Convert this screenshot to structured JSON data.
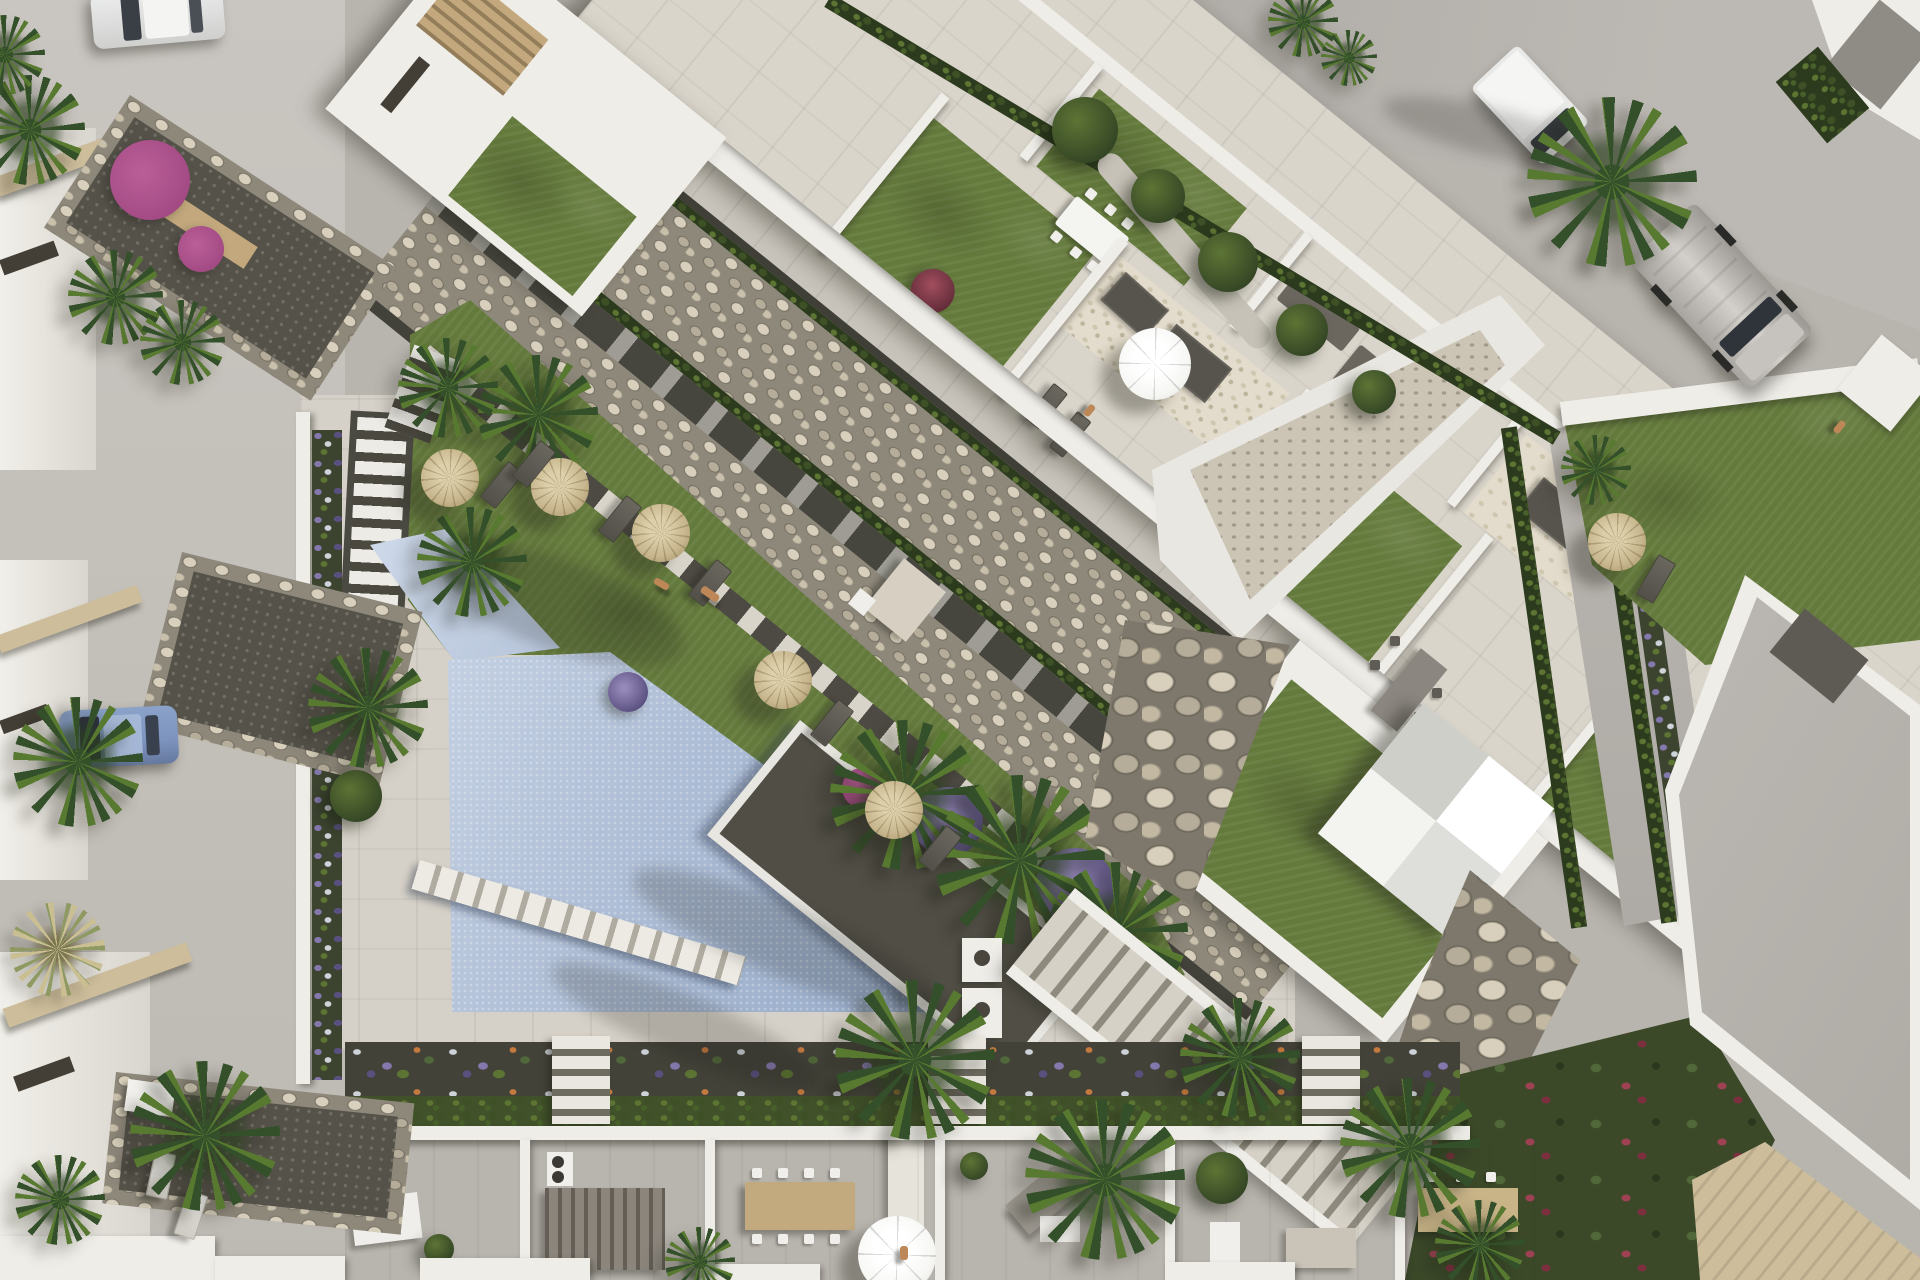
{
  "scene": {
    "kind": "aerial-architectural-render",
    "subject": "Top-down 3D visualization of a new-build residential complex with communal pool, lawns, straw parasols, roof terraces, streets and parked vehicles",
    "time_of_day": "late afternoon with long shadows toward lower-left",
    "no_visible_text": true
  },
  "palette": {
    "base": "#b8b4ae",
    "street": "#c4c0ba",
    "road": "#a8a49f",
    "roadLight": "#bcb8b3",
    "deck": "#d6d1c8",
    "pavement": "#dad5cb",
    "wall": "#efede8",
    "wallShade": "#b9b5ae",
    "pool": "#b2c1d8",
    "poolLight": "#cfdaea",
    "poolDeep": "#93a8c7",
    "grass": "#647a3c",
    "grassLight": "#7e9350",
    "grassDark": "#46572b",
    "stoneBed": "#8e887b",
    "stoneLight": "#d8d0bc",
    "stoneMid": "#b5ad99",
    "stoneEdge": "#676257",
    "soil": "#504e45",
    "gravelDark": "#434239",
    "hedge": "#3e5026",
    "hedgeLight": "#5d7533",
    "forest": "#3b4929",
    "palm": "#587a30",
    "palmDark": "#34502a",
    "straw": "#c7b68e",
    "strawDark": "#9f8d60",
    "canvasWhite": "#f6f6f3",
    "purple": "#8478ad",
    "purpleDeep": "#5a5080",
    "magenta": "#a34a84",
    "sand": "#cdbd9b",
    "wood": "#c2a87c",
    "mat": "#57544d",
    "carBlue": "#7c93be",
    "metal": "#bab7b2",
    "skin": "#bd8757",
    "redPlant": "#9c4252"
  },
  "objects": {
    "vehicles": [
      {
        "name": "white-car",
        "location": "top-left street"
      },
      {
        "name": "blue-car",
        "location": "left street, parked by facade"
      },
      {
        "name": "white-box-van",
        "location": "top-right road"
      },
      {
        "name": "silver-van",
        "location": "top-right driveway"
      }
    ],
    "amenities": [
      {
        "name": "swimming-pool",
        "color_key": "pool"
      },
      {
        "name": "pool-step-bridge"
      },
      {
        "name": "straw-parasols",
        "count": 6
      },
      {
        "name": "white-terrace-parasol",
        "count": 1
      },
      {
        "name": "white-pyramid-tent",
        "count": 1
      },
      {
        "name": "sun-loungers",
        "count": 9
      },
      {
        "name": "outdoor-dining-sets",
        "count": 5
      },
      {
        "name": "outdoor-shower"
      },
      {
        "name": "garden-stairs",
        "count": 3
      },
      {
        "name": "white-railed-ramp"
      }
    ],
    "landscape": [
      {
        "name": "diagonal-pebble-dry-riverbed"
      },
      {
        "name": "boulder-retaining-walls"
      },
      {
        "name": "communal-lawn"
      },
      {
        "name": "roof-terrace-lawns"
      },
      {
        "name": "palm-trees",
        "count": "~20"
      },
      {
        "name": "lavender-and-white-flower-borders"
      },
      {
        "name": "magenta-bougainvillea"
      },
      {
        "name": "rock-bordered-street-planters",
        "count": 3
      },
      {
        "name": "hedges-along-roads"
      }
    ],
    "people": [
      {
        "name": "sunbather-on-pool-deck"
      },
      {
        "name": "person-on-roof-terrace"
      },
      {
        "name": "pedestrian-top-right-road"
      },
      {
        "name": "person-near-pool-shower"
      }
    ],
    "buildings": [
      {
        "name": "main-apartment-block-with-roof-terraces",
        "orientation_deg": 39
      },
      {
        "name": "townhouse-row-bottom",
        "units_visible": 6
      },
      {
        "name": "townhouse-facades-left-street"
      },
      {
        "name": "villa-with-gray-roof-bottom-right"
      },
      {
        "name": "building-corner-top-right"
      }
    ]
  }
}
